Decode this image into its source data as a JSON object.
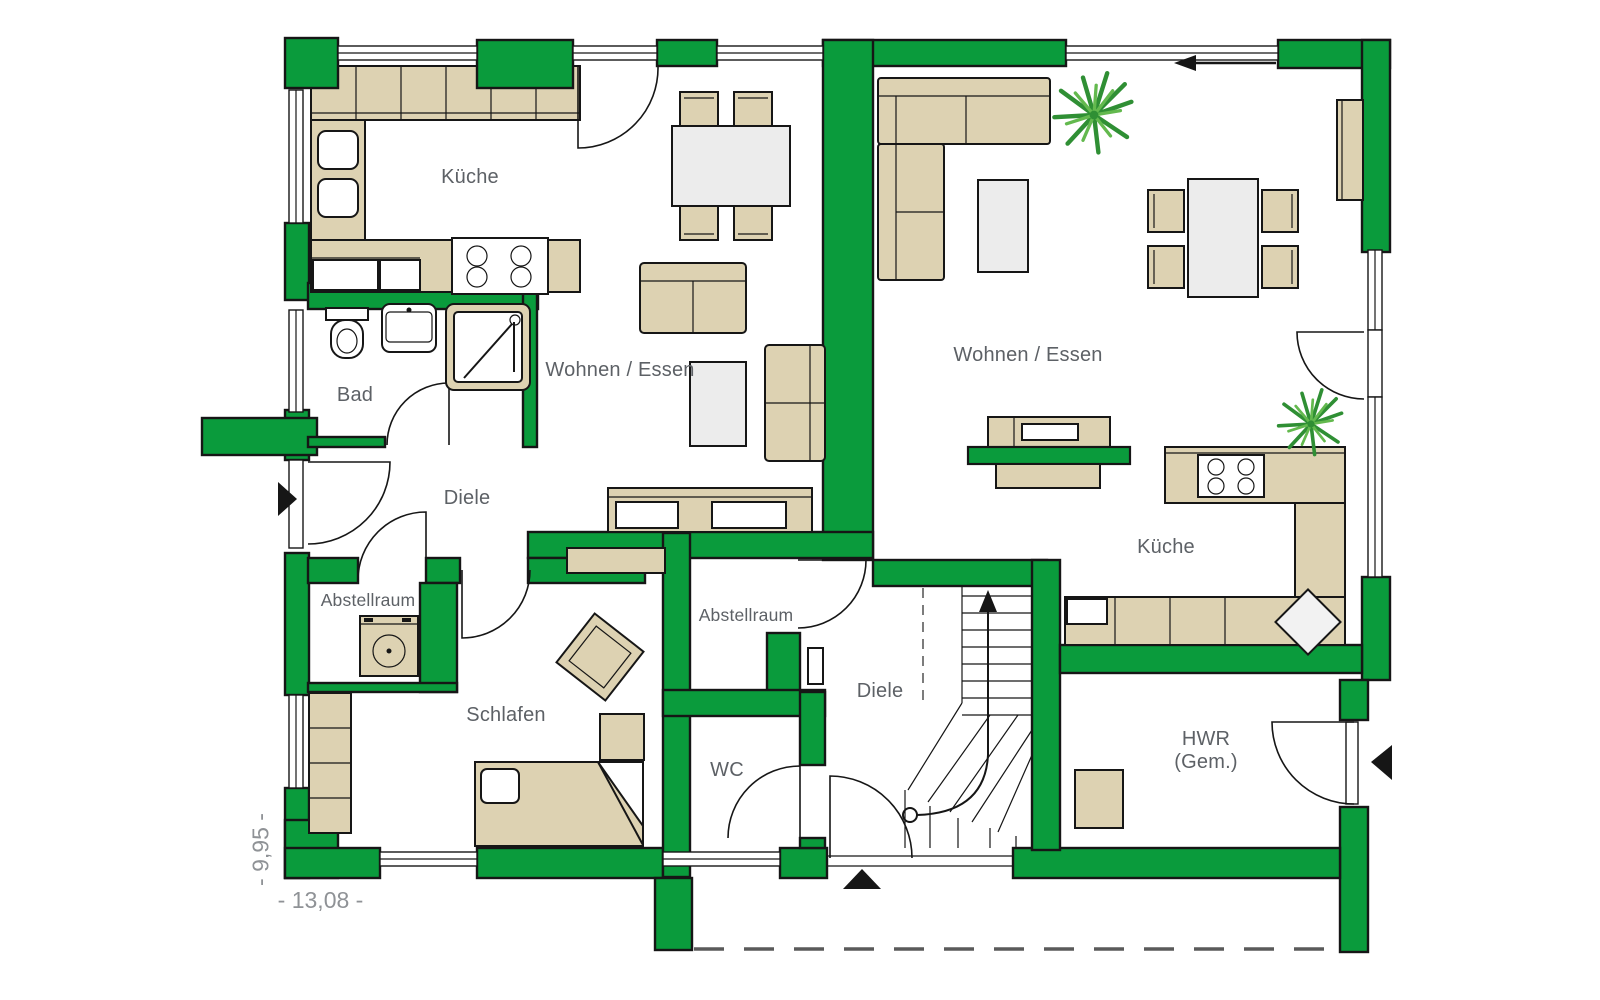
{
  "floorplan": {
    "unit_left": {
      "kueche": "Küche",
      "wohnen_essen": "Wohnen / Essen",
      "bad": "Bad",
      "diele": "Diele",
      "abstellraum": "Abstellraum",
      "schlafen": "Schlafen"
    },
    "unit_right": {
      "wohnen_essen": "Wohnen / Essen",
      "kueche": "Küche",
      "diele": "Diele",
      "abstellraum": "Abstellraum",
      "wc": "WC",
      "hwr_line1": "HWR",
      "hwr_line2": "(Gem.)"
    },
    "dimensions": {
      "total_width": "- 13,08 -",
      "total_depth": "- 9,95 -"
    },
    "colors": {
      "wall_green": "#0a9b3c",
      "furniture_beige": "#ddd2b2",
      "outline_black": "#161616",
      "label_gray": "#5d6166",
      "dimension_gray": "#8f9296",
      "surface_gray": "#ececec",
      "plant_green": "#2f8f34",
      "plant_green_light": "#63b94e"
    }
  }
}
